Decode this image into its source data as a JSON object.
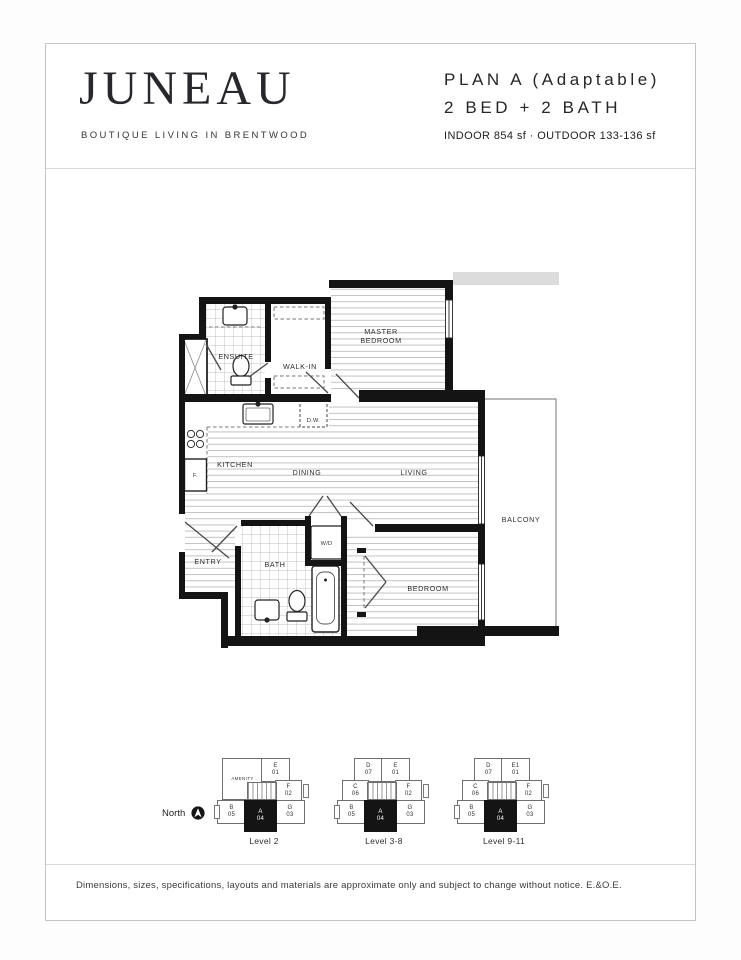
{
  "header": {
    "logo": "JUNEAU",
    "tagline": "BOUTIQUE LIVING IN BRENTWOOD",
    "plan_title": "PLAN A (Adaptable)",
    "plan_subtitle": "2 BED + 2 BATH",
    "plan_area": "INDOOR 854 sf · OUTDOOR 133-136 sf"
  },
  "floorplan": {
    "labels": {
      "ensuite": "ENSUITE",
      "walk_in": "WALK-IN",
      "master_1": "MASTER",
      "master_2": "BEDROOM",
      "dishwasher": "D.W.",
      "kitchen": "KITCHEN",
      "fridge": "F.",
      "dining": "DINING",
      "living": "LIVING",
      "balcony": "BALCONY",
      "entry": "ENTRY",
      "bath": "BATH",
      "washer_dryer": "W/D",
      "bedroom": "BEDROOM"
    }
  },
  "keyplans": {
    "north": "North",
    "levels": [
      {
        "label": "Level 2",
        "amenity": "AMENITY",
        "units": {
          "e": {
            "l": "E",
            "n": "01"
          },
          "f": {
            "l": "F",
            "n": "02"
          },
          "b": {
            "l": "B",
            "n": "05"
          },
          "a": {
            "l": "A",
            "n": "04"
          },
          "g": {
            "l": "G",
            "n": "03"
          }
        }
      },
      {
        "label": "Level 3-8",
        "units": {
          "d": {
            "l": "D",
            "n": "07"
          },
          "e": {
            "l": "E",
            "n": "01"
          },
          "c": {
            "l": "C",
            "n": "06"
          },
          "f": {
            "l": "F",
            "n": "02"
          },
          "b": {
            "l": "B",
            "n": "05"
          },
          "a": {
            "l": "A",
            "n": "04"
          },
          "g": {
            "l": "G",
            "n": "03"
          }
        }
      },
      {
        "label": "Level 9-11",
        "units": {
          "d": {
            "l": "D",
            "n": "07"
          },
          "e": {
            "l": "E1",
            "n": "01"
          },
          "c": {
            "l": "C",
            "n": "06"
          },
          "f": {
            "l": "F",
            "n": "02"
          },
          "b": {
            "l": "B",
            "n": "05"
          },
          "a": {
            "l": "A",
            "n": "04"
          },
          "g": {
            "l": "G",
            "n": "03"
          }
        }
      }
    ]
  },
  "disclaimer": "Dimensions, sizes, specifications, layouts and materials are approximate only and subject to change without notice. E.&O.E."
}
